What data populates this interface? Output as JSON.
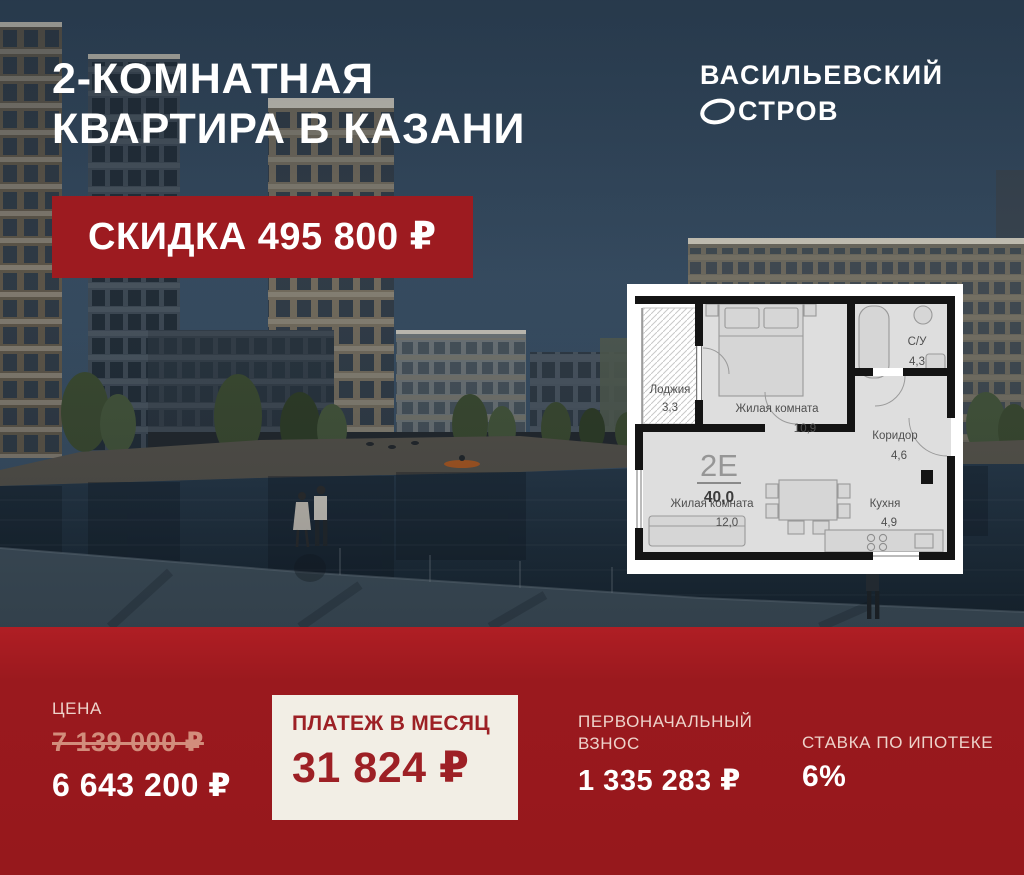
{
  "header": {
    "title_line1": "2-КОМНАТНАЯ",
    "title_line2": "КВАРТИРА В КАЗАНИ"
  },
  "logo": {
    "line1": "ВАСИЛЬЕВСКИЙ",
    "line2": "ОСТРОВ",
    "line2_rest": "СТРОВ"
  },
  "badge": {
    "text": "СКИДКА 495 800 ₽"
  },
  "floor_plan": {
    "type_label": "2Е",
    "total_area": "40,0",
    "rooms": [
      {
        "name": "Лоджия",
        "area": "3,3"
      },
      {
        "name": "Жилая комната",
        "area": "10,9"
      },
      {
        "name": "С/У",
        "area": "4,3"
      },
      {
        "name": "Коридор",
        "area": "4,6"
      },
      {
        "name": "Жилая комната",
        "area": "12,0"
      },
      {
        "name": "Кухня",
        "area": "4,9"
      }
    ]
  },
  "pricing": {
    "price_label": "ЦЕНА",
    "old_price": "7 139 000 ₽",
    "new_price": "6 643 200 ₽",
    "monthly_label": "ПЛАТЕЖ В МЕСЯЦ",
    "monthly_value": "31 824 ₽",
    "down_payment_label_line1": "ПЕРВОНАЧАЛЬНЫЙ",
    "down_payment_label_line2": "ВЗНОС",
    "down_payment_value": "1 335 283 ₽",
    "rate_label": "СТАВКА ПО ИПОТЕКЕ",
    "rate_value": "6%"
  },
  "colors": {
    "accent_red": "#96181c",
    "badge_red": "#9d1b20",
    "cream_box": "#f2eee5",
    "dark_red_text": "#9d2025",
    "old_price": "#d28d7c",
    "label_pink": "#eed3cb",
    "sky": "#33495e"
  }
}
